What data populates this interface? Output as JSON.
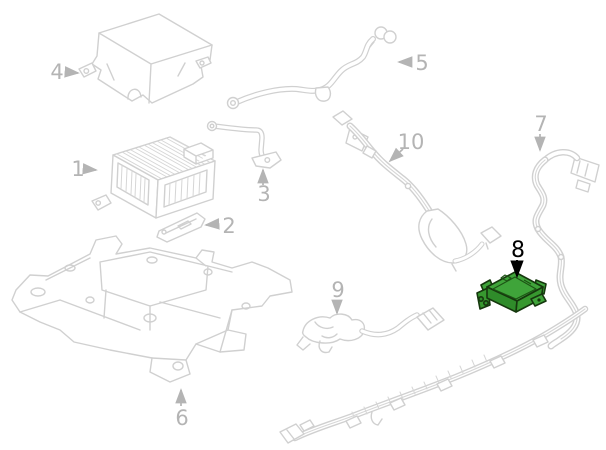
{
  "diagram": {
    "background_color": "#ffffff",
    "sketch_line_color": "#d0d0d0",
    "callout_color": "#b4b4b4",
    "highlight": {
      "fill": "#3fa43a",
      "fill_dark": "#2f8c2a",
      "fill_mid": "#37982f",
      "outline": "#16380e",
      "label_color": "#000000"
    },
    "callouts": [
      {
        "label": "1",
        "highlighted": false
      },
      {
        "label": "2",
        "highlighted": false
      },
      {
        "label": "3",
        "highlighted": false
      },
      {
        "label": "4",
        "highlighted": false
      },
      {
        "label": "5",
        "highlighted": false
      },
      {
        "label": "6",
        "highlighted": false
      },
      {
        "label": "7",
        "highlighted": false
      },
      {
        "label": "8",
        "highlighted": true
      },
      {
        "label": "9",
        "highlighted": false
      },
      {
        "label": "10",
        "highlighted": false
      }
    ]
  }
}
